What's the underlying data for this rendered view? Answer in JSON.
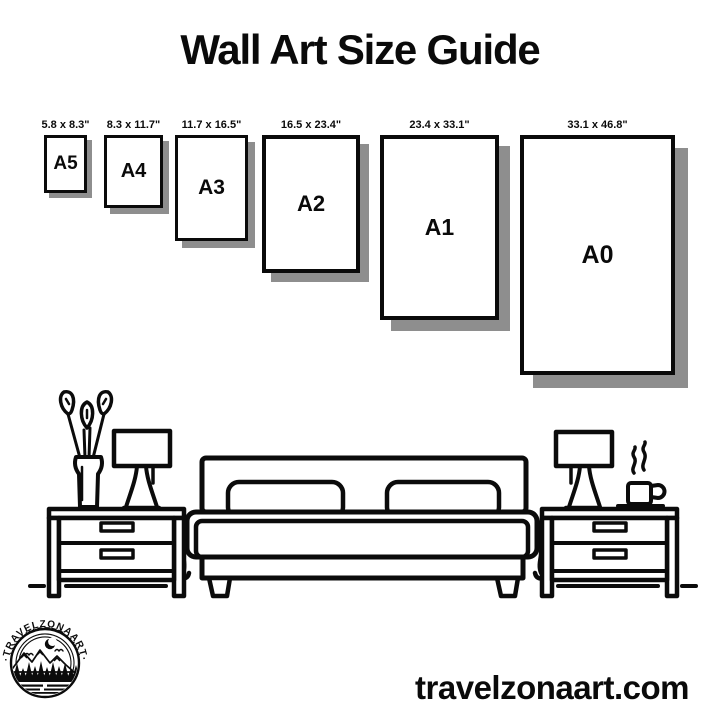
{
  "title": "Wall Art Size Guide",
  "colors": {
    "ink": "#0a0a0a",
    "shadow": "#8e8e8e",
    "background": "#ffffff"
  },
  "size_guide": {
    "items": [
      {
        "label": "A5",
        "dimensions": "5.8 x 8.3\""
      },
      {
        "label": "A4",
        "dimensions": "8.3 x 11.7\""
      },
      {
        "label": "A3",
        "dimensions": "11.7 x 16.5\""
      },
      {
        "label": "A2",
        "dimensions": "16.5 x 23.4\""
      },
      {
        "label": "A1",
        "dimensions": "23.4 x 33.1\""
      },
      {
        "label": "A0",
        "dimensions": "33.1 x 46.8\""
      }
    ]
  },
  "logo": {
    "arc_text_top": "·TRAVELZONAART·",
    "arc_text_bottom": "·TRAVELZONAART·"
  },
  "footer": {
    "website": "travelzonaart.com"
  }
}
